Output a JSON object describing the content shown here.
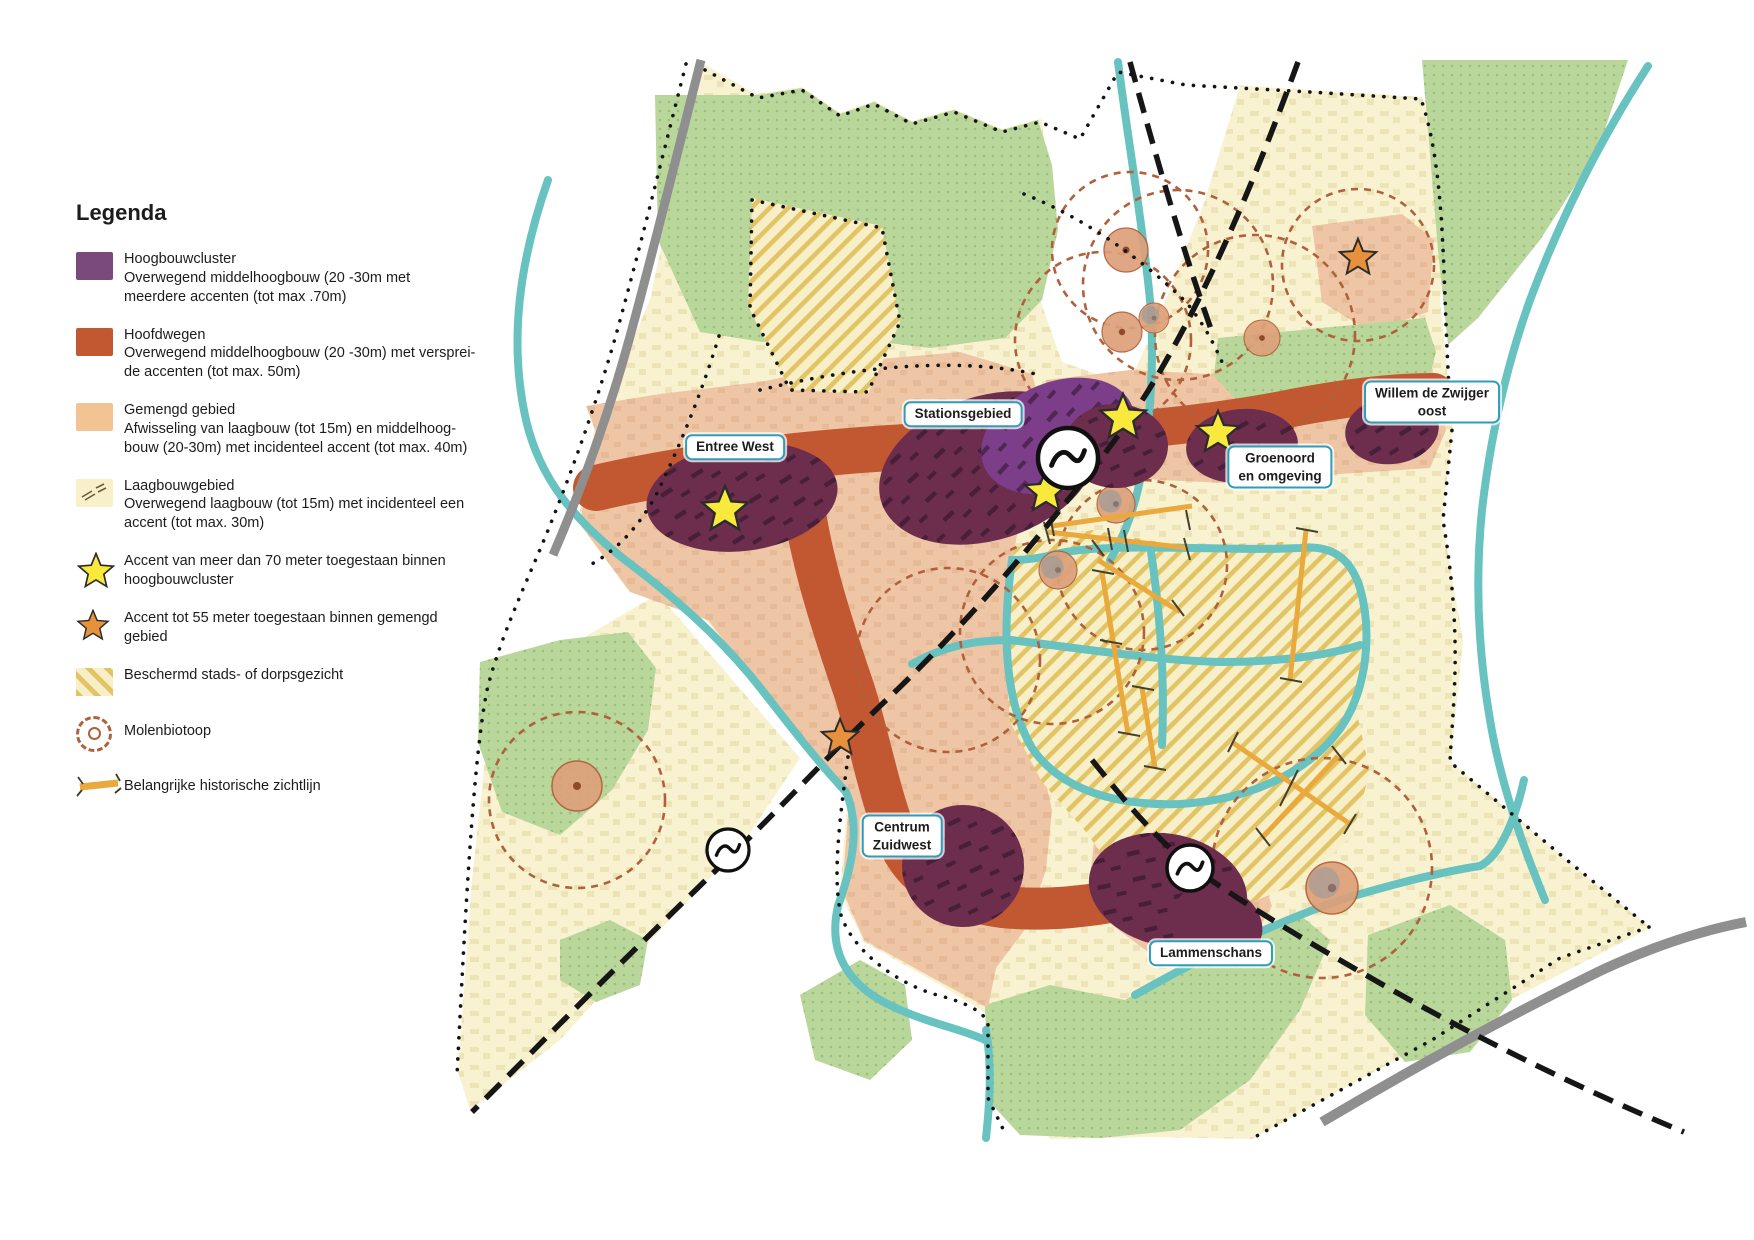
{
  "legend": {
    "title": "Legenda",
    "items": [
      {
        "id": "hoogbouwcluster",
        "color": "#7b4a7d",
        "lines": [
          "Hoogbouwcluster",
          "Overwegend middelhoogbouw (20 -30m met",
          "meerdere accenten (tot max .70m)"
        ]
      },
      {
        "id": "hoofdwegen",
        "color": "#c25832",
        "lines": [
          "Hoofdwegen",
          "Overwegend middelhoogbouw (20 -30m) met versprei-",
          "de accenten (tot max. 50m)"
        ]
      },
      {
        "id": "gemengd-gebied",
        "color": "#f3c493",
        "lines": [
          "Gemengd gebied",
          "Afwisseling van laagbouw (tot 15m) en middelhoog-",
          "bouw (20-30m) met incidenteel accent (tot max. 40m)"
        ]
      },
      {
        "id": "laagbouwgebied",
        "color": "#f7f0c9",
        "lines": [
          "Laagbouwgebied",
          "Overwegend laagbouw (tot 15m) met incidenteel een",
          "accent (tot max. 30m)"
        ]
      },
      {
        "id": "accent-70m",
        "color": "#f9e93c",
        "lines": [
          "Accent van meer dan 70 meter toegestaan binnen",
          "hoogbouwcluster"
        ]
      },
      {
        "id": "accent-55m",
        "color": "#e8913c",
        "lines": [
          "Accent tot 55 meter toegestaan binnen gemengd",
          "gebied"
        ]
      },
      {
        "id": "beschermd-stadsgezicht",
        "color": "#e2c464",
        "lines": [
          "Beschermd stads- of dorpsgezicht"
        ]
      },
      {
        "id": "molenbiotoop",
        "color": "#b0603c",
        "lines": [
          "Molenbiotoop"
        ]
      },
      {
        "id": "historische-zichtlijn",
        "color": "#e9a93c",
        "lines": [
          "Belangrijke historische zichtlijn"
        ]
      }
    ]
  },
  "map": {
    "area_labels": [
      {
        "id": "entree-west",
        "lines": [
          "Entree West"
        ]
      },
      {
        "id": "stationsgebied",
        "lines": [
          "Stationsgebied"
        ]
      },
      {
        "id": "groenoord",
        "lines": [
          "Groenoord",
          "en omgeving"
        ]
      },
      {
        "id": "willem-de-zwijger-oost",
        "lines": [
          "Willem de Zwijger",
          "oost"
        ]
      },
      {
        "id": "centrum-zuidwest",
        "lines": [
          "Centrum",
          "Zuidwest"
        ]
      },
      {
        "id": "lammenschans",
        "lines": [
          "Lammenschans"
        ]
      }
    ],
    "colors": {
      "hoogbouwcluster_blob": "#6d2e4e",
      "station_cluster_bright": "#7c3e88",
      "hoofdweg_corridor": "#c25832",
      "gemengd_gebied": "#efc6a5",
      "laagbouw_gebied": "#f8f2d1",
      "park_green": "#b9d69b",
      "water_teal": "#67c2c0",
      "molenbiotoop_ring": "#b0603c",
      "sightline_orange": "#e9a93c",
      "accent_star_yellow": "#f9e93c",
      "accent_star_orange": "#e8913c",
      "label_border_teal": "#2f9db8"
    }
  }
}
